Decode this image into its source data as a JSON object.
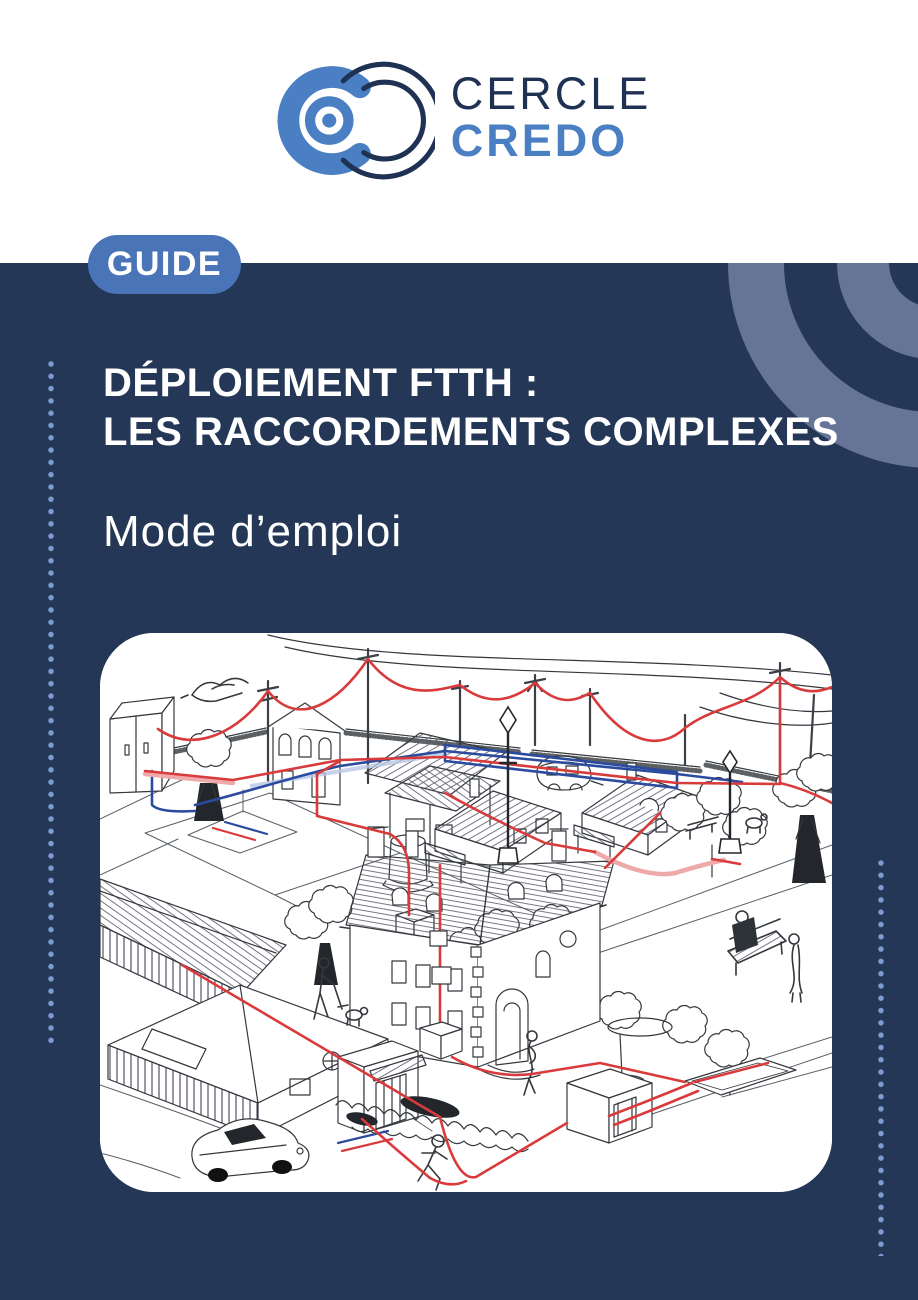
{
  "page": {
    "kind": "guide-cover"
  },
  "logo": {
    "line1": "CERCLE",
    "line2": "CREDO",
    "icon": "concentric-circles-logo-icon"
  },
  "badge": {
    "label": "GUIDE"
  },
  "title": {
    "line1": "DÉPLOIEMENT FTTH :",
    "line2": "LES RACCORDEMENTS COMPLEXES",
    "subtitle": "Mode d’emploi"
  },
  "illustration": {
    "description": "Hand-drawn isometric village scene showing FTTH fibre deployment: red aerial cables strung between telephone poles, red and blue underground cable routes, a street cabinet, houses, a multi-storey stone building, a caravan, trees, lamp posts, people, a car and a cable trench.",
    "cable_colors": {
      "fiber_red": "#d93a3c",
      "fiber_blue": "#2b4b9e"
    }
  },
  "colors": {
    "background_navy": "#253757",
    "badge_blue": "#4a74b8",
    "logo_blue": "#4a7fc4",
    "logo_navy": "#203253",
    "dotted_line_blue": "#7d9dd1",
    "decorative_arc_slate": "#6b7a9d",
    "panel_white": "#ffffff"
  }
}
